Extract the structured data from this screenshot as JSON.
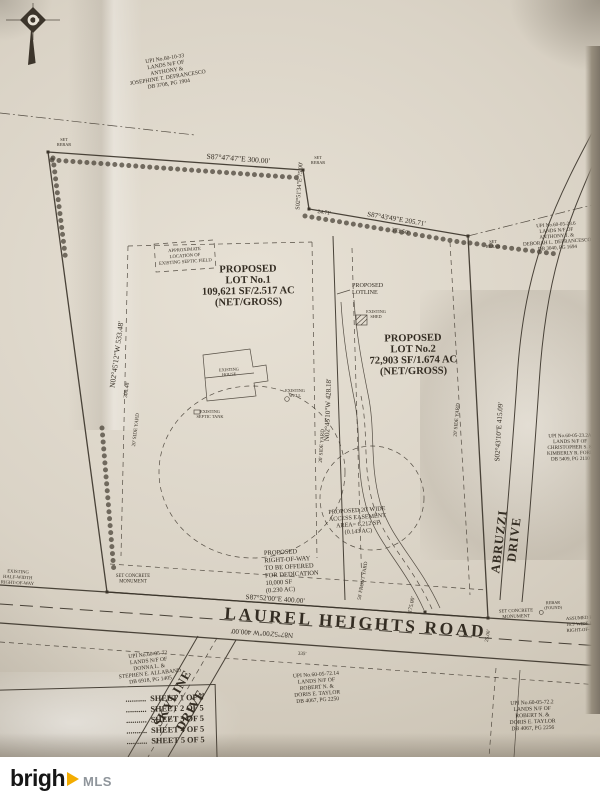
{
  "branding": {
    "logo_prefix": "brigh",
    "logo_mls": "MLS"
  },
  "colors": {
    "paper": "#dad3c6",
    "ink": "#3c352b",
    "logo_yellow": "#f3ac00",
    "logo_gray": "#8f959b"
  },
  "lot1": {
    "l1": "PROPOSED",
    "l2": "LOT No.1",
    "l3": "109,621 SF/2.517 AC",
    "l4": "(NET/GROSS)"
  },
  "lot2": {
    "l1": "PROPOSED",
    "l2": "LOT No.2",
    "l3": "72,903 SF/1.674 AC",
    "l4": "(NET/GROSS)"
  },
  "lotline": {
    "l1": "PROPOSED",
    "l2": "LOTLINE"
  },
  "septic_field": {
    "l1": "APPROXIMATE",
    "l2": "LOCATION OF",
    "l3": "EXISTING SEPTIC FIELD"
  },
  "row_dedication": {
    "l1": "PROPOSED",
    "l2": "RIGHT-OF-WAY",
    "l3": "TO BE OFFERED",
    "l4": "FOR DEDICATION",
    "l5": "10,000 SF",
    "l6": "(0.230 AC)"
  },
  "access_easement": {
    "l1": "PROPOSED 20' WIDE",
    "l2": "ACCESS EASEMENT",
    "l3": "AREA= 6,212 SF",
    "l4": "(0.143 AC)"
  },
  "roads": {
    "laurel": "LAUREL HEIGHTS ROAD",
    "skyline_1": "SKYLINE",
    "skyline_2": "DRIVE",
    "abruzzi_1": "ABRUZZI",
    "abruzzi_2": "DRIVE"
  },
  "bearings": {
    "top": "S87°47'47\"E  300.00'",
    "jog": "S02°51'34\"E  75.00'",
    "jog_dim": "24.71'",
    "diag": "S87°43'49\"E  205.71'",
    "diag_dim": "373.50'",
    "west": "N02°45'12\"W  533.48'",
    "west_dim": "308.48'",
    "lotline": "N02°45'10\"W  428.18'",
    "east": "S02°43'10\"E  415.09'",
    "road_n": "S87°52'00\"E  400.00'",
    "road_s": "N87°52'00\"W  400.00'",
    "dim_175": "175.00'",
    "dim_25": "25.00'",
    "dim_335": "335'"
  },
  "markers": {
    "set_rebar_1": "SET",
    "set_rebar_2": "REBAR",
    "monument_1": "SET CONCRETE",
    "monument_2": "MONUMENT",
    "rebar_found_1": "REBAR",
    "rebar_found_2": "(FOUND)",
    "assumed_1": "ASSUMED EX.",
    "assumed_2": "16.5' WIDE HALF-",
    "assumed_3": "RIGHT-OF-",
    "existing_row_1": "EXISTING",
    "existing_row_2": "HALF-WIDTH",
    "existing_row_3": "RIGHT-OF-WAY",
    "front_yard": "50' FRONT YARD",
    "side_yard": "20' SIDE YARD",
    "existing_house_1": "EXISTING",
    "existing_house_2": "HOUSE",
    "existing_well_1": "EXISTING",
    "existing_well_2": "WELL",
    "existing_septic_1": "EXISTING",
    "existing_septic_2": "SEPTIC TANK",
    "existing_shed_1": "EXISTING",
    "existing_shed_2": "SHED"
  },
  "parcels": [
    {
      "lines": [
        "UPI No.60-10-33",
        "LANDS N/F OF",
        "ANTHONY &",
        "JOSEPHINE T. DEFRANCESCO",
        "DB 3708, PG 1904"
      ]
    },
    {
      "lines": [
        "UPI No.60-05-23.6",
        "LANDS N/F OF",
        "ANTHONY J. &",
        "DEBORAH L. DEFRANCESCO",
        "DB 3040, PG 1694"
      ]
    },
    {
      "lines": [
        "UPI No.60-05-23.2A",
        "LANDS N/F OF",
        "CHRISTOPHER S. &",
        "KIMBERLY R. FORD",
        "DB 5409, PG 2110"
      ]
    },
    {
      "lines": [
        "UPI No.60-05-72",
        "LANDS N/F OF",
        "DONNA L. &",
        "STEPHEN E. ALLABAND",
        "DB 6918, PG 1405"
      ]
    },
    {
      "lines": [
        "UPI No.60-05-72.14",
        "LANDS N/F OF",
        "ROBERT N. &",
        "DORIS E. TAYLOR",
        "DB 4067, PG 2250"
      ]
    },
    {
      "lines": [
        "UPI No.60-05-72.2",
        "LANDS N/F OF",
        "ROBERT N. &",
        "DORIS E. TAYLOR",
        "DB 4067, PG 2256"
      ]
    }
  ],
  "sheet_index": {
    "leader": "..........",
    "rows": [
      "SHEET 1 OF 5",
      "SHEET 2 OF 5",
      "SHEET 3 OF 5",
      "SHEET 4 OF 5",
      "SHEET 5 OF 5"
    ]
  }
}
